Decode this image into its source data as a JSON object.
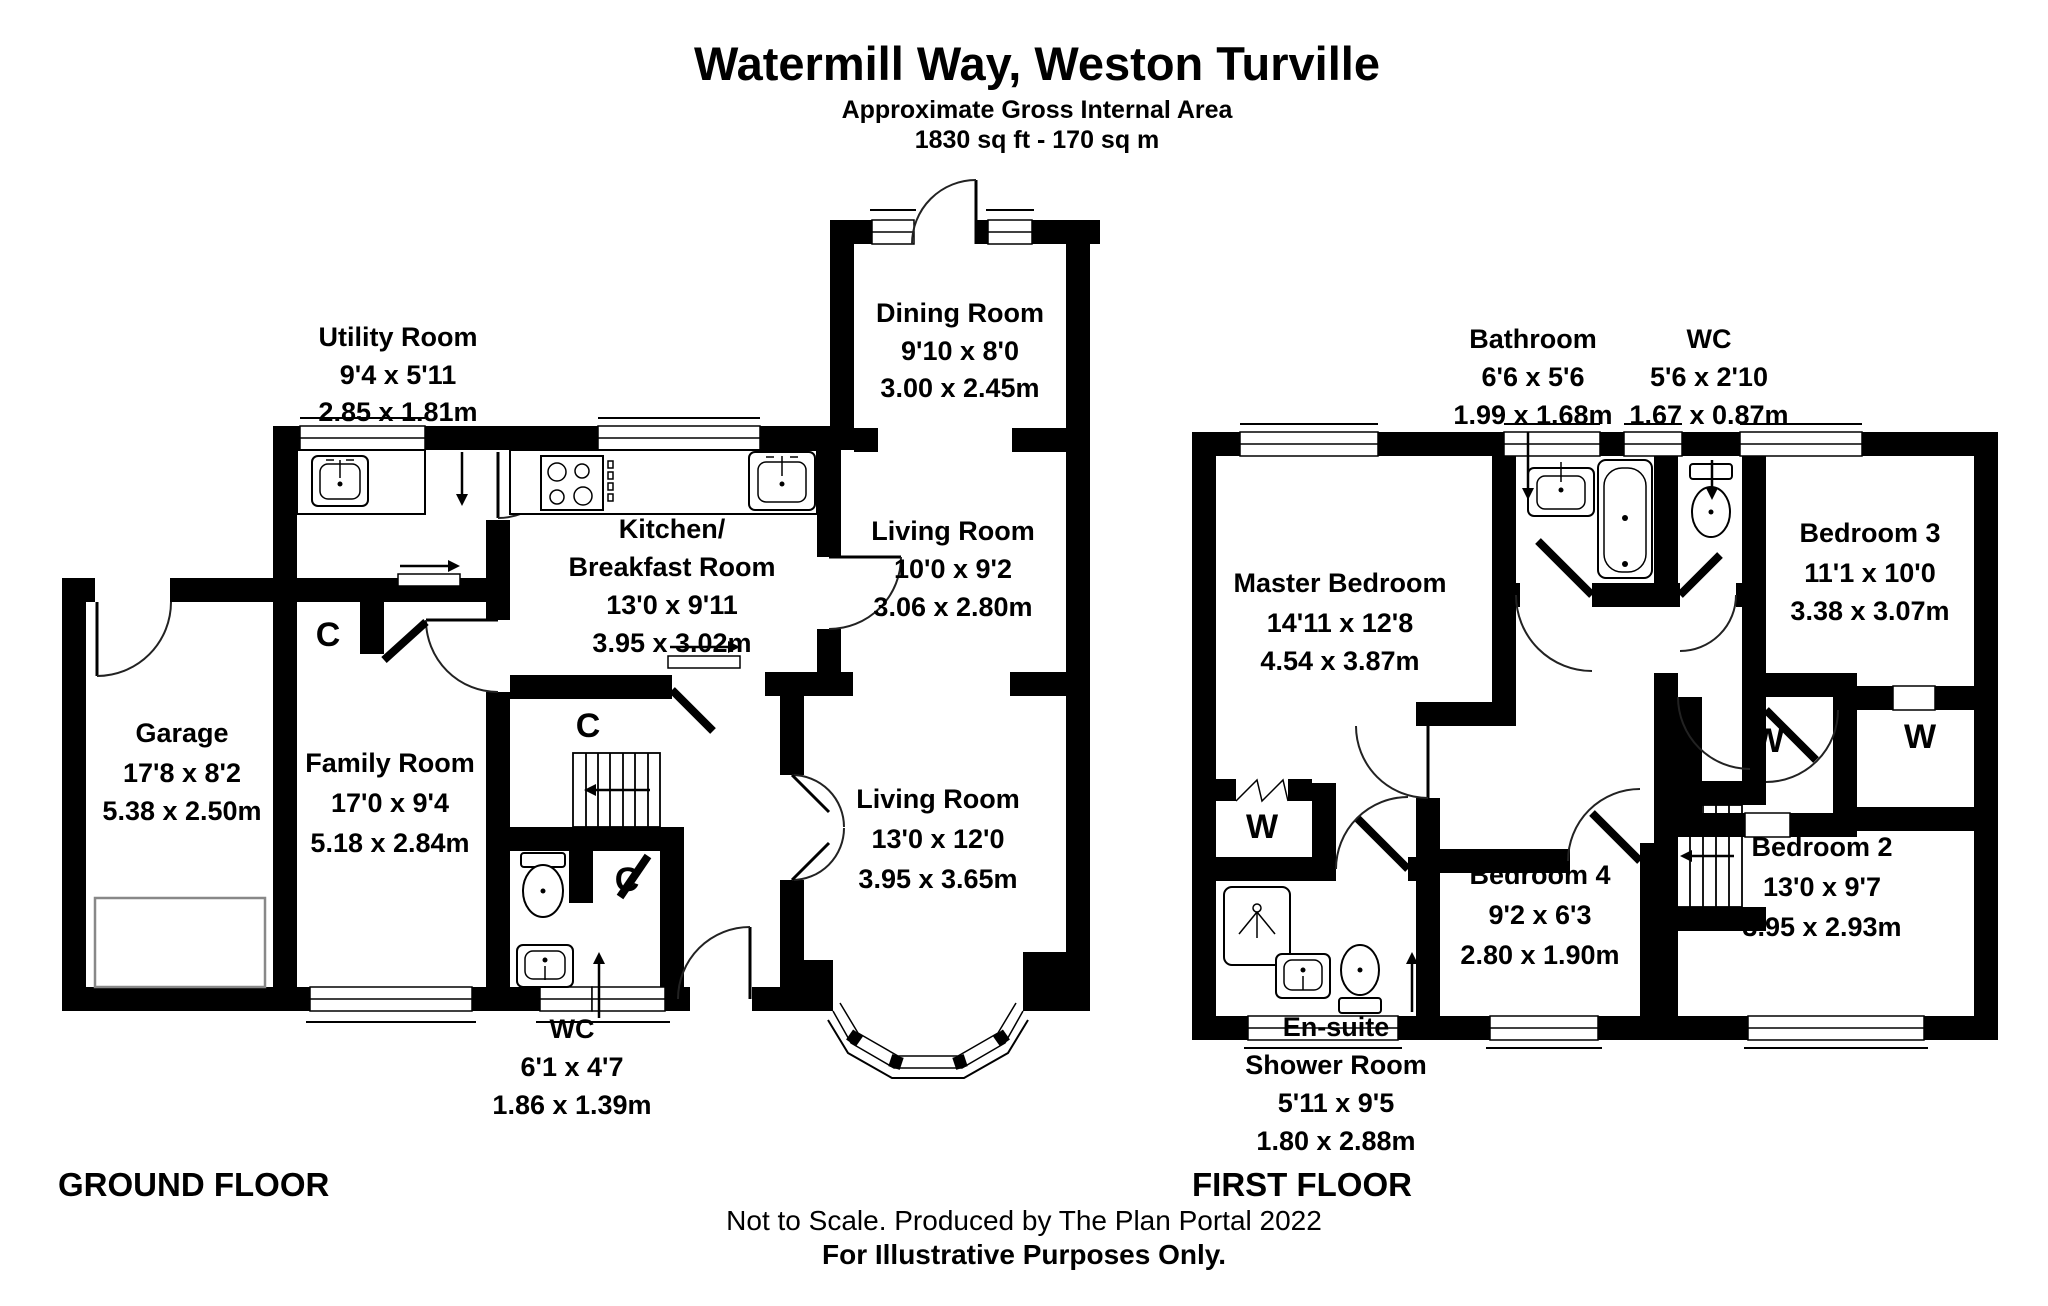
{
  "header": {
    "title": "Watermill Way, Weston Turville",
    "subtitle": "Approximate Gross Internal Area",
    "area": "1830 sq ft - 170 sq m"
  },
  "footer": {
    "note": "Not to Scale. Produced by The Plan Portal 2022",
    "disclaimer": "For Illustrative Purposes Only."
  },
  "ground_floor": {
    "label": "GROUND FLOOR",
    "cupboard_label": "C",
    "rooms": {
      "utility": {
        "name": "Utility Room",
        "imperial": "9'4 x 5'11",
        "metric": "2.85 x 1.81m"
      },
      "dining": {
        "name": "Dining Room",
        "imperial": "9'10 x 8'0",
        "metric": "3.00 x 2.45m"
      },
      "kitchen": {
        "name_line1": "Kitchen/",
        "name_line2": "Breakfast Room",
        "imperial": "13'0 x 9'11",
        "metric": "3.95 x 3.02m"
      },
      "living1": {
        "name": "Living Room",
        "imperial": "10'0 x 9'2",
        "metric": "3.06 x 2.80m"
      },
      "living2": {
        "name": "Living Room",
        "imperial": "13'0 x 12'0",
        "metric": "3.95 x 3.65m"
      },
      "family": {
        "name": "Family Room",
        "imperial": "17'0 x 9'4",
        "metric": "5.18 x 2.84m"
      },
      "garage": {
        "name": "Garage",
        "imperial": "17'8 x 8'2",
        "metric": "5.38 x 2.50m"
      },
      "wc": {
        "name": "WC",
        "imperial": "6'1 x 4'7",
        "metric": "1.86 x 1.39m"
      }
    }
  },
  "first_floor": {
    "label": "FIRST FLOOR",
    "wardrobe_label": "W",
    "rooms": {
      "master": {
        "name": "Master Bedroom",
        "imperial": "14'11 x 12'8",
        "metric": "4.54 x 3.87m"
      },
      "bathroom": {
        "name": "Bathroom",
        "imperial": "6'6 x 5'6",
        "metric": "1.99 x 1.68m"
      },
      "wc": {
        "name": "WC",
        "imperial": "5'6 x 2'10",
        "metric": "1.67 x 0.87m"
      },
      "bedroom3": {
        "name": "Bedroom 3",
        "imperial": "11'1 x 10'0",
        "metric": "3.38 x 3.07m"
      },
      "bedroom2": {
        "name": "Bedroom 2",
        "imperial": "13'0 x 9'7",
        "metric": "3.95 x 2.93m"
      },
      "bedroom4": {
        "name": "Bedroom 4",
        "imperial": "9'2 x 6'3",
        "metric": "2.80 x 1.90m"
      },
      "ensuite": {
        "name_line1": "En-suite",
        "name_line2": "Shower Room",
        "imperial": "5'11 x 9'5",
        "metric": "1.80 x 2.88m"
      }
    }
  }
}
